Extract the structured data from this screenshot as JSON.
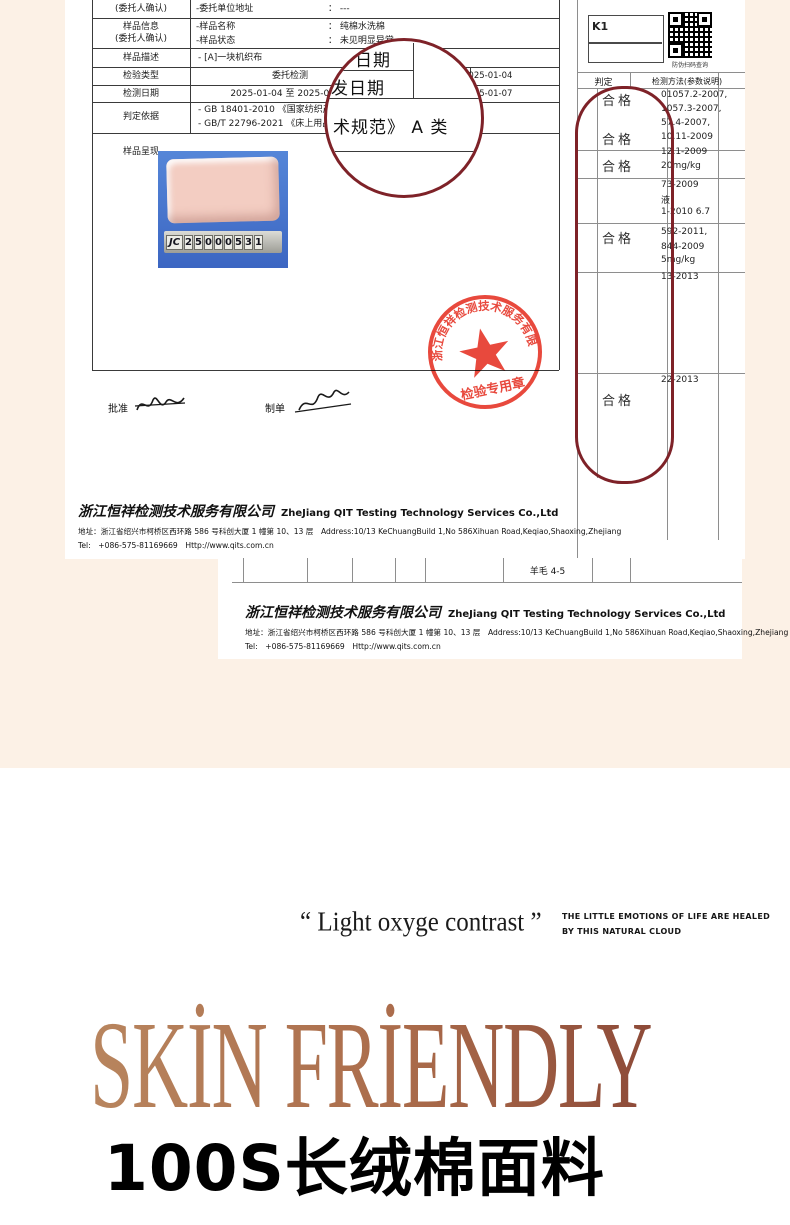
{
  "colors": {
    "page_beige": "#fcf1e6",
    "lens_maroon": "#7e2228",
    "stamp_red": "#e73b2e",
    "headline_copper": "#a96a4a",
    "photo_blue": "#4878cf"
  },
  "report": {
    "box_code": "K1",
    "qr_caption": "防伪扫码查询",
    "info": {
      "r1_label": "(委托人确认)",
      "r1_key": "-委托单位地址",
      "r1_val": "： ---",
      "r2_label1": "样品信息",
      "r2_label2": "(委托人确认)",
      "r2_key1": "-样品名称",
      "r2_val1": "： 纯棉水洗棉",
      "r2_key2": "-样品状态",
      "r2_val2": "： 未见明显异常",
      "r3_label": "样品描述",
      "r3_val": "- [A]一块机织布",
      "r4_label": "检验类型",
      "r4_val": "委托检测",
      "r4_date": "2025-01-04",
      "r5_label": "检测日期",
      "r5_val": "2025-01-04 至 2025-01-07",
      "r5_date": "2025-01-07",
      "r6_label": "判定依据",
      "r6_line1": "- GB 18401-2010 《国家纺织产品基本",
      "r6_line2": "- GB/T 22796-2021 《床上用品》 合格",
      "r7_label": "样品呈现"
    },
    "lens": {
      "top": "日期",
      "mid": "发日期",
      "bottom": "术规范》 A 类"
    },
    "photo_tiles": [
      "JC",
      "2",
      "5",
      "0",
      "0",
      "0",
      "5",
      "3",
      "1"
    ],
    "results": {
      "header_verdict": "判定",
      "header_method": "检测方法(参数说明)",
      "verdicts": [
        "合格",
        "合格",
        "合格",
        "合格",
        "合格"
      ],
      "methods": [
        "01057.2-2007,",
        "1057.3-2007,",
        "57.4-2007,",
        "10.11-2009",
        "12.1-2009",
        "20mg/kg",
        "73-2009",
        "液",
        "1-2010 6.7",
        "592-2011,",
        "844-2009",
        "5mg/kg",
        "13-2013",
        "22-2013"
      ]
    },
    "signature": {
      "approve": "批准",
      "prepare": "制单"
    },
    "stamp": {
      "company": "浙江恒祥检测技术服务有限公司",
      "seal_title": "检验专用章"
    },
    "footer": {
      "company_cn": "浙江恒祥检测技术服务有限公司",
      "company_en": "ZheJiang QIT Testing Technology Services Co.,Ltd",
      "address": "地址：浙江省绍兴市柯桥区西环路 586 号科创大厦 1 幢第 10、13 层　Address:10/13 KeChuangBuild 1,No 586Xihuan Road,Keqiao,Shaoxing,Zhejiang",
      "tel": "Tel:　+086-575-81169669　Http://www.qits.com.cn"
    }
  },
  "page2": {
    "wool_cell": "羊毛 4-5"
  },
  "marketing": {
    "quote": "“ Light oxyge contrast ”",
    "tagline1": "THE LITTLE EMOTIONS OF LIFE ARE HEALED",
    "tagline2": "BY THIS NATURAL CLOUD",
    "headline": "SKİN FRİENDLY",
    "subheadline": "100S长绒棉面料"
  }
}
